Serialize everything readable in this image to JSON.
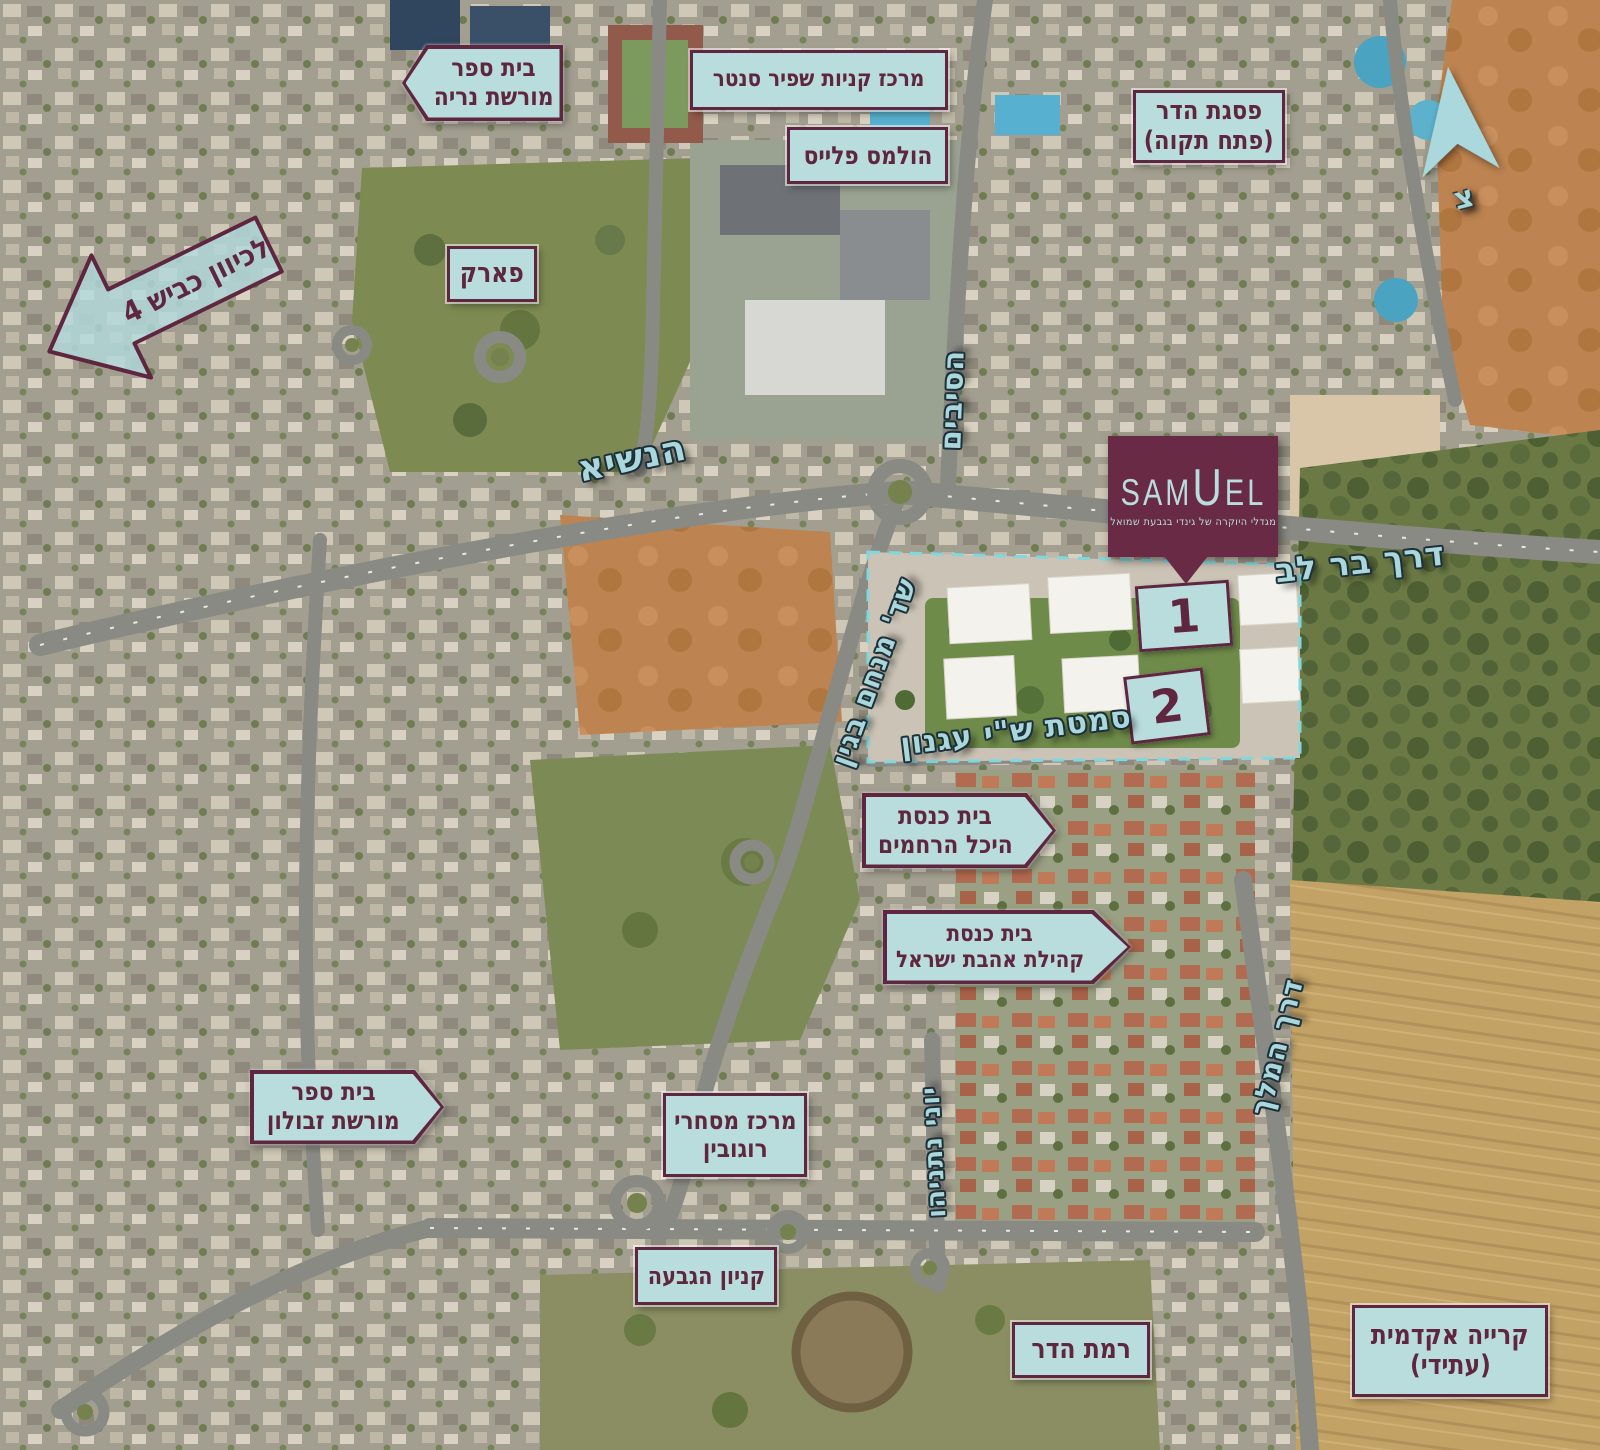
{
  "project": {
    "logo_part1": "SAM",
    "logo_part2": "U",
    "logo_part3": "EL",
    "tagline": "מגדלי היוקרה של גינדי בגבעת שמואל",
    "building_1_number": "1",
    "building_2_number": "2",
    "logo_bg_color": "#682a44",
    "logo_text_color": "#b9dcdd"
  },
  "compass": {
    "north_letter": "צ"
  },
  "streets": {
    "hanasi": "הנשיא",
    "hasivim": "הסיבים",
    "bar_lev": "דרך בר לב",
    "menachem_begin": "שד' מנחם בגין",
    "agnon": "סמטת ש\"י עגנון",
    "yoni_netanyahu": "יוני נתניהו",
    "derech_hamelech": "דרך המלך"
  },
  "labels": {
    "route4": {
      "line1": "לכיוון כביש 4"
    },
    "morshet_neria": {
      "line1": "בית ספר",
      "line2": "מורשת נריה"
    },
    "shapir_center": {
      "line1": "מרכז קניות שפיר סנטר"
    },
    "holmes_place": {
      "line1": "הולמס פלייס"
    },
    "psagat_hadar": {
      "line1": "פסגת הדר",
      "line2": "(פתח תקוה)"
    },
    "park": {
      "line1": "פארק"
    },
    "morshet_zevulun": {
      "line1": "בית ספר",
      "line2": "מורשת זבולון"
    },
    "heichal_harachamim": {
      "line1": "בית כנסת",
      "line2": "היכל הרחמים"
    },
    "ahavat_israel": {
      "line1": "בית כנסת",
      "line2": "קהילת אהבת ישראל"
    },
    "rogovin": {
      "line1": "מרכז מסחרי",
      "line2": "רוגובין"
    },
    "kanyon_hagiva": {
      "line1": "קניון הגבעה"
    },
    "ramat_hadar": {
      "line1": "רמת הדר"
    },
    "kirya_akademit": {
      "line1": "קרייה אקדמית",
      "line2": "(עתידי)"
    }
  },
  "style_colors": {
    "label_background": "#b9dcdd",
    "label_border_text": "#5f2640",
    "street_text": "#a9d7dc"
  }
}
